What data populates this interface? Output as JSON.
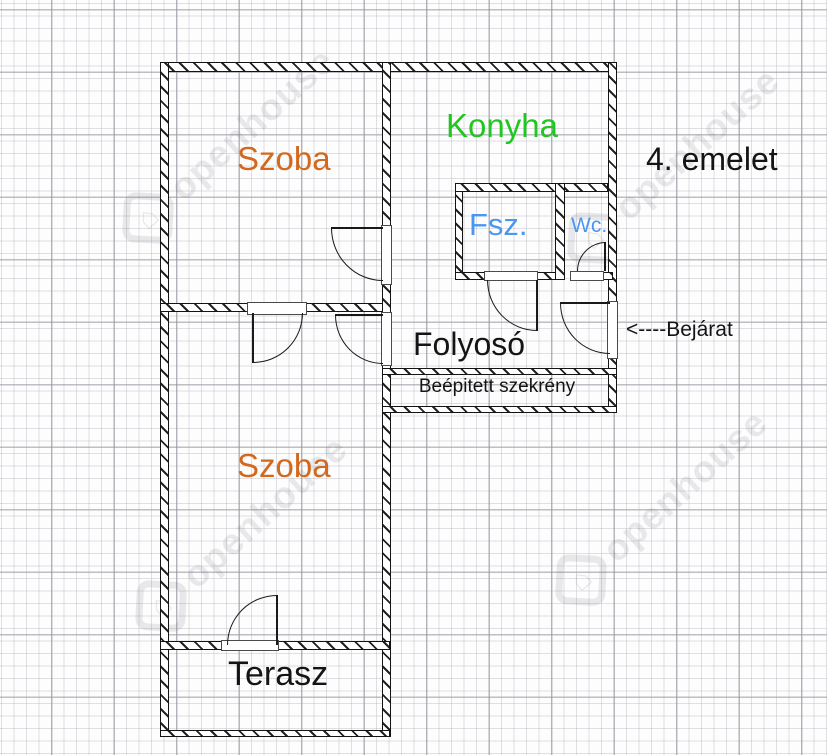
{
  "plan": {
    "floor_label": "4. emelet",
    "entrance_label": "<----Bejárat",
    "watermark_text": "openhouse",
    "colors": {
      "room_orange": "#D2691E",
      "kitchen_green": "#21C621",
      "utility_blue": "#4A97F2",
      "ink_black": "#141414"
    },
    "rooms": {
      "szoba_top": {
        "label": "Szoba",
        "color": "#D2691E"
      },
      "konyha": {
        "label": "Konyha",
        "color": "#21C621"
      },
      "fsz": {
        "label": "Fsz.",
        "color": "#4A97F2"
      },
      "wc": {
        "label": "Wc.",
        "color": "#4A97F2"
      },
      "folyoso": {
        "label": "Folyosó",
        "color": "#141414"
      },
      "szekreny": {
        "label": "Beépitett szekrény",
        "color": "#141414"
      },
      "szoba_bottom": {
        "label": "Szoba",
        "color": "#D2691E"
      },
      "terasz": {
        "label": "Terasz",
        "color": "#141414"
      }
    }
  }
}
